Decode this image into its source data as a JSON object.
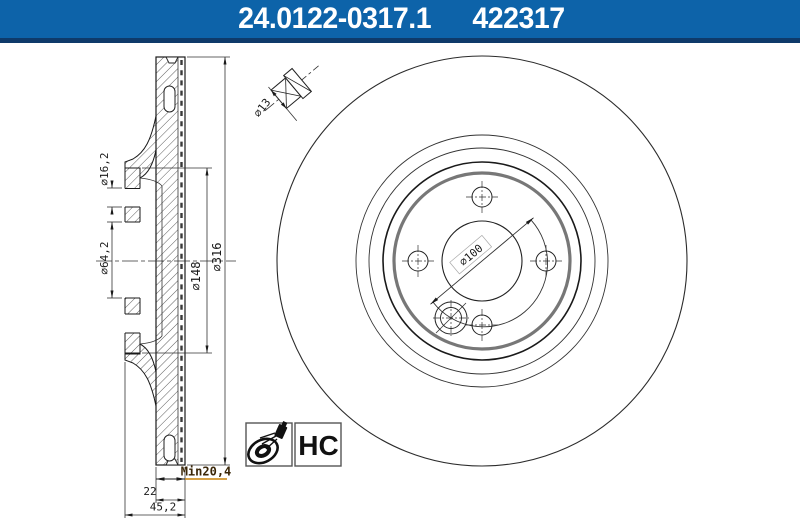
{
  "header": {
    "part_number": "24.0122-0317.1",
    "ref_number": "422317",
    "bg_color": "#0d63a9",
    "stripe_color": "#0e3a6a"
  },
  "section_view": {
    "dim_outer_diameter": "⌀316",
    "dim_hat_diameter": "⌀148",
    "dim_bore_diameter": "⌀64,2",
    "dim_bolt_hole_diameter": "⌀16,2",
    "dim_min_thickness": "Min20,4",
    "dim_thickness": "22",
    "dim_total_width": "45,2",
    "min_underline_color": "#c8820a"
  },
  "detail_view": {
    "dim_wheel_bolt_hole": "⌀13"
  },
  "front_view": {
    "dim_bolt_circle": "⌀100"
  },
  "badges": {
    "coating_label": "HC",
    "spray_icon": "spray-can-disc-icon"
  }
}
